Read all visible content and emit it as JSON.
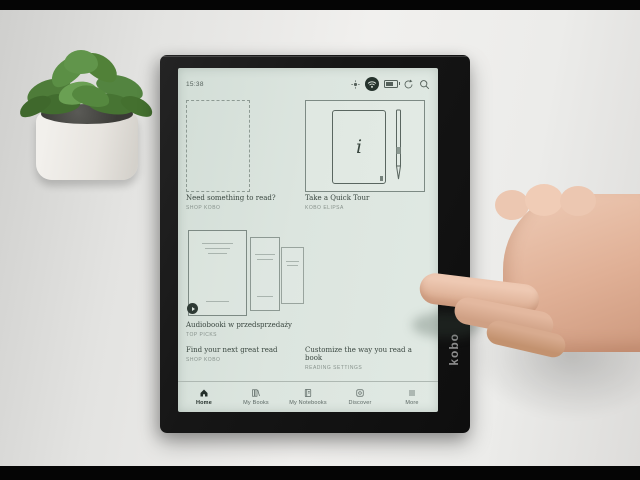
{
  "status_bar": {
    "time": "15:38",
    "icon_names": [
      "brightness-icon",
      "wifi-icon",
      "battery-icon",
      "sync-icon",
      "search-icon"
    ]
  },
  "home": {
    "cards": [
      {
        "title": "Need something to read?",
        "subtitle": "SHOP KOBO"
      },
      {
        "title": "Take a Quick Tour",
        "subtitle": "KOBO ELIPSA",
        "glyph": "i"
      },
      {
        "title": "Audiobooki w przedsprzedaży",
        "subtitle": "TOP PICKS"
      }
    ],
    "links": [
      {
        "title": "Find your next great read",
        "subtitle": "SHOP KOBO"
      },
      {
        "title": "Customize the way you read a book",
        "subtitle": "READING SETTINGS"
      }
    ]
  },
  "nav": {
    "items": [
      {
        "label": "Home",
        "active": true
      },
      {
        "label": "My Books",
        "active": false
      },
      {
        "label": "My Notebooks",
        "active": false
      },
      {
        "label": "Discover",
        "active": false
      },
      {
        "label": "More",
        "active": false
      }
    ]
  },
  "device": {
    "brand": "kobo"
  },
  "colors": {
    "screen_bg": "#dce5df",
    "bezel": "#161616",
    "text_primary": "#39463f",
    "text_secondary": "#87928c",
    "nav_active": "#242f2a"
  }
}
